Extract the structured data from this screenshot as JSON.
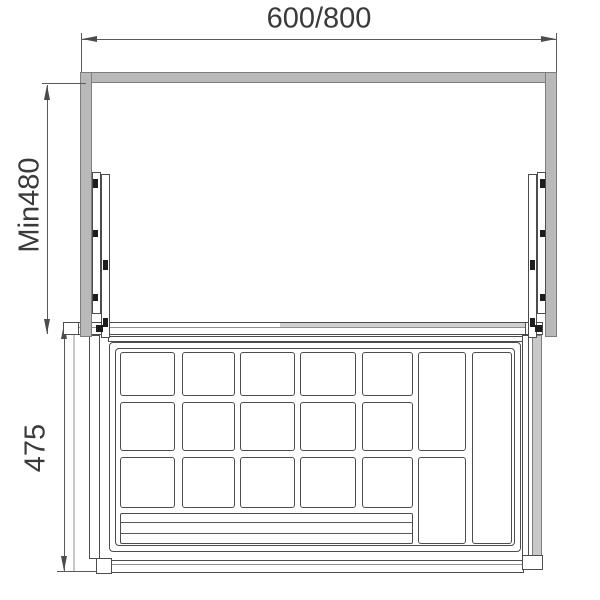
{
  "title": "pull-out-basket-installation-drawing",
  "dimensions": {
    "width_label": "600/800",
    "depth_label": "Min480",
    "drawer_depth_label": "475"
  },
  "colors": {
    "background": "#ffffff",
    "panel_gray": "#b9b9b9",
    "panel_light": "#c9c9c9",
    "panel_border": "#7e7e7e",
    "line_dark": "#4c4c4c",
    "line_dim": "#5a5a5a",
    "line_light": "#c8c8c8",
    "text": "#3a3a3a"
  }
}
